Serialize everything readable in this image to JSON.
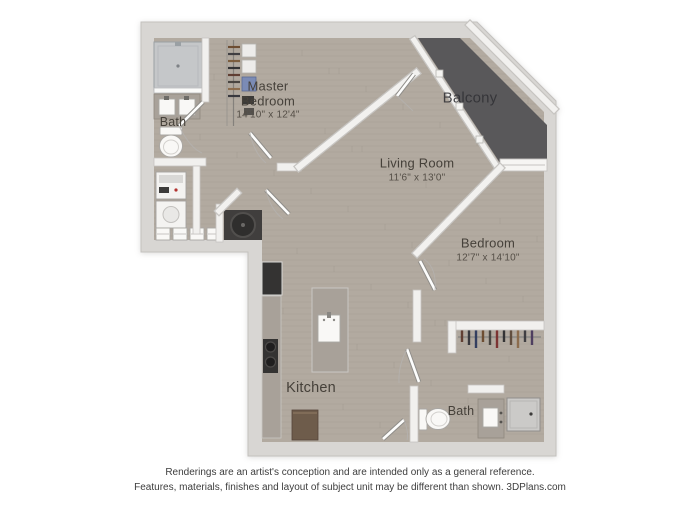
{
  "rooms": {
    "master_bedroom": {
      "name": "Master Bedroom",
      "dims": "14'10\" x 12'4\""
    },
    "living_room": {
      "name": "Living Room",
      "dims": "11'6\" x 13'0\""
    },
    "bedroom": {
      "name": "Bedroom",
      "dims": "12'7\" x 14'10\""
    },
    "balcony": {
      "name": "Balcony"
    },
    "bath_master": {
      "name": "Bath"
    },
    "bath_second": {
      "name": "Bath"
    },
    "kitchen": {
      "name": "Kitchen"
    }
  },
  "disclaimer": {
    "line1": "Renderings are an artist's conception and are intended only as a general reference.",
    "line2": "Features, materials, finishes and layout of subject unit may be different than shown. 3DPlans.com"
  },
  "colors": {
    "wood": "#b2aaa0",
    "exterior_wall": "#d8d6d3",
    "interior_wall": "#f1f0ee",
    "balcony_floor": "#59585a",
    "granite": "#a8a199",
    "appliance_dark": "#343332",
    "alcove": "#403e3d",
    "cabinet_brown": "#6e5c4b",
    "storage_blue": "#7b8bb5",
    "label_text": "#46413a",
    "disclaimer_text": "#3d3d3d",
    "bedroom_clothes": [
      "#5d3a2e",
      "#33343a",
      "#2e3a5d",
      "#6b4a2e",
      "#44403c",
      "#7a2e2e",
      "#2e2e30",
      "#5d4a3a",
      "#8a6a4a",
      "#3a3a3e",
      "#4a3a5d"
    ],
    "closet_clothes": [
      "#6b4a2e",
      "#3a3a3e",
      "#7a5a3a",
      "#2e2e30",
      "#5d3a2e",
      "#44403c",
      "#8a6a4a",
      "#33343a"
    ]
  }
}
